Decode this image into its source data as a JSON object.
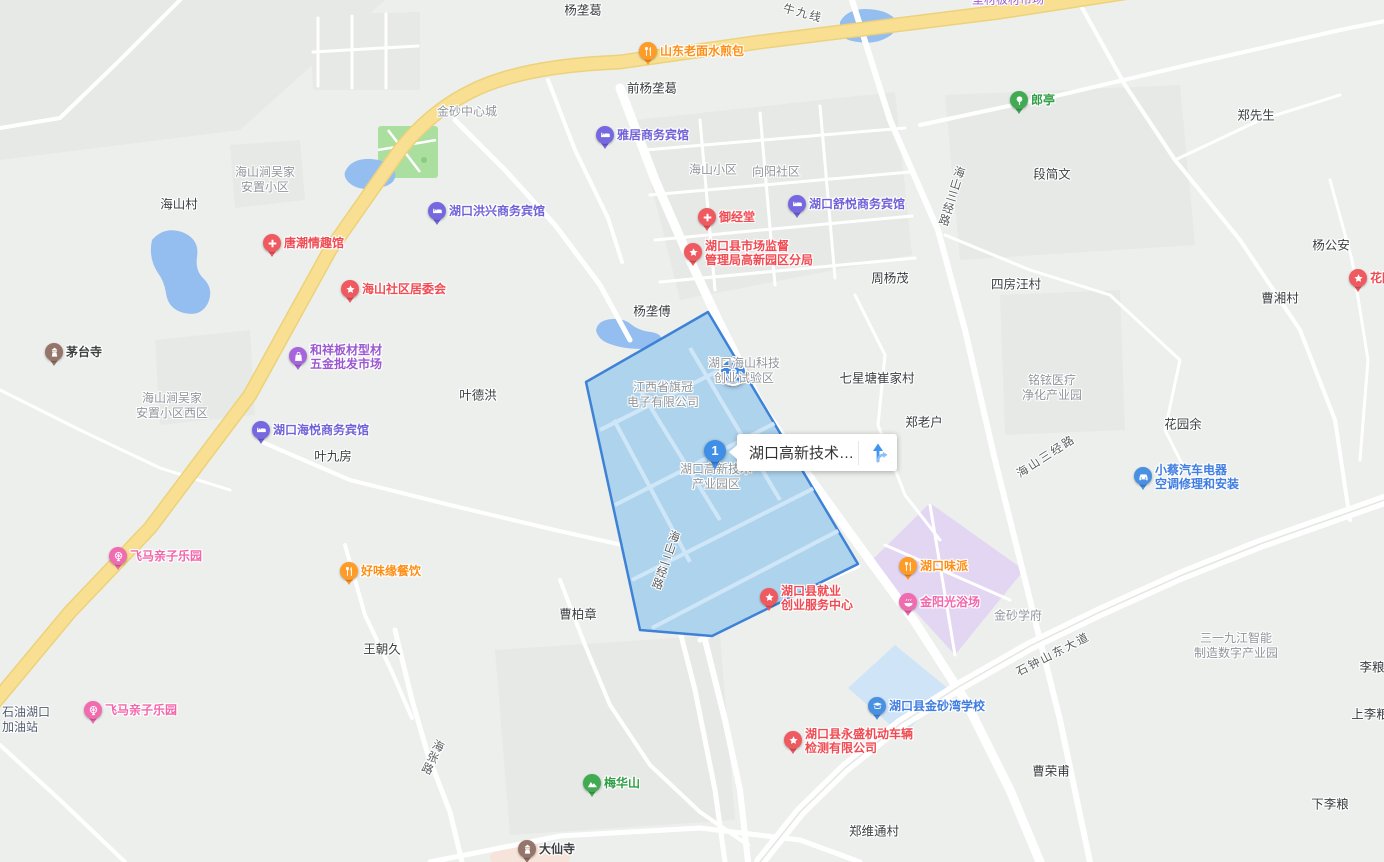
{
  "map": {
    "selection_popup": {
      "title": "湖口高新技术…",
      "marker_number": "1"
    },
    "palette": {
      "hotel": {
        "bg": "#7668e0",
        "text": "#6f62d9"
      },
      "food": {
        "bg": "#ff9b27",
        "text": "#ff8e15"
      },
      "red": {
        "bg": "#ef5a60",
        "text": "#f04a52"
      },
      "green": {
        "bg": "#41ab53",
        "text": "#2f9e44"
      },
      "pink": {
        "bg": "#f06bb0",
        "text": "#f266ab"
      },
      "blue": {
        "bg": "#4a90e2",
        "text": "#3f7de0"
      },
      "shop": {
        "bg": "#a765dd",
        "text": "#9b59d0"
      },
      "temple": {
        "bg": "#95756a",
        "text": "#3d4043"
      },
      "parking": {
        "bg": "#3f87e0",
        "text": "#3f87e0"
      },
      "selection": {
        "fill": "#aed3ed",
        "border": "#3e82d6"
      }
    },
    "poi": [
      {
        "icon": "food",
        "palette": "food",
        "x": 648,
        "y": 51,
        "lines": [
          "山东老面水煎包"
        ]
      },
      {
        "icon": "hotel",
        "palette": "hotel",
        "x": 605,
        "y": 135,
        "lines": [
          "雅居商务宾馆"
        ]
      },
      {
        "icon": "hotel",
        "palette": "hotel",
        "x": 437,
        "y": 211,
        "lines": [
          "湖口洪兴商务宾馆"
        ]
      },
      {
        "icon": "hotel",
        "palette": "hotel",
        "x": 797,
        "y": 204,
        "lines": [
          "湖口舒悦商务宾馆"
        ]
      },
      {
        "icon": "medical",
        "palette": "red",
        "x": 707,
        "y": 217,
        "lines": [
          "御经堂"
        ]
      },
      {
        "icon": "medical",
        "palette": "red",
        "x": 272,
        "y": 243,
        "lines": [
          "唐潮情趣馆"
        ]
      },
      {
        "icon": "star",
        "palette": "red",
        "x": 693,
        "y": 252,
        "lines": [
          "湖口县市场监督",
          "管理局高新园区分局"
        ]
      },
      {
        "icon": "tree",
        "palette": "green",
        "x": 1019,
        "y": 100,
        "lines": [
          "郎亭"
        ]
      },
      {
        "icon": "star",
        "palette": "red",
        "x": 350,
        "y": 289,
        "lines": [
          "海山社区居委会"
        ]
      },
      {
        "icon": "shop",
        "palette": "shop",
        "x": 298,
        "y": 356,
        "lines": [
          "和祥板材型材",
          "五金批发市场"
        ]
      },
      {
        "icon": "temple",
        "palette": "temple",
        "x": 54,
        "y": 352,
        "lines": [
          "茅台寺"
        ]
      },
      {
        "icon": "hotel",
        "palette": "hotel",
        "x": 261,
        "y": 430,
        "lines": [
          "湖口海悦商务宾馆"
        ]
      },
      {
        "icon": "parking",
        "palette": "parking",
        "x": 731,
        "y": 370,
        "big": true
      },
      {
        "icon": "fun",
        "palette": "pink",
        "x": 118,
        "y": 556,
        "lines": [
          "飞马亲子乐园"
        ]
      },
      {
        "icon": "food",
        "palette": "food",
        "x": 349,
        "y": 571,
        "lines": [
          "好味缘餐饮"
        ]
      },
      {
        "icon": "fun",
        "palette": "pink",
        "x": 93,
        "y": 710,
        "lines": [
          "飞马亲子乐园"
        ]
      },
      {
        "icon": "star",
        "palette": "red",
        "x": 769,
        "y": 597,
        "lines": [
          "湖口县就业",
          "创业服务中心"
        ]
      },
      {
        "icon": "food",
        "palette": "food",
        "x": 908,
        "y": 566,
        "lines": [
          "湖口味派"
        ]
      },
      {
        "icon": "bath",
        "palette": "pink",
        "x": 908,
        "y": 602,
        "lines": [
          "金阳光浴场"
        ]
      },
      {
        "icon": "car",
        "palette": "blue",
        "x": 1143,
        "y": 476,
        "lines": [
          "小蔡汽车电器",
          "空调修理和安装"
        ]
      },
      {
        "icon": "school",
        "palette": "blue",
        "x": 877,
        "y": 706,
        "lines": [
          "湖口县金砂湾学校"
        ]
      },
      {
        "icon": "star",
        "palette": "red",
        "x": 793,
        "y": 740,
        "lines": [
          "湖口县永盛机动车辆",
          "检测有限公司"
        ]
      },
      {
        "icon": "mountain",
        "palette": "green",
        "x": 592,
        "y": 783,
        "lines": [
          "梅华山"
        ]
      },
      {
        "icon": "temple",
        "palette": "temple",
        "x": 527,
        "y": 849,
        "lines": [
          "大仙寺"
        ]
      },
      {
        "icon": "star",
        "palette": "red",
        "x": 1358,
        "y": 278,
        "lines": [
          "花园"
        ]
      }
    ],
    "place_labels": [
      {
        "text": "杨垄葛",
        "x": 583,
        "y": 9
      },
      {
        "text": "前杨垄葛",
        "x": 652,
        "y": 87
      },
      {
        "text": "郑先生",
        "x": 1256,
        "y": 114
      },
      {
        "text": "段简文",
        "x": 1052,
        "y": 173
      },
      {
        "text": "海山村",
        "x": 179,
        "y": 203
      },
      {
        "text": "杨公安",
        "x": 1331,
        "y": 244
      },
      {
        "text": "周杨茂",
        "x": 890,
        "y": 277
      },
      {
        "text": "四房汪村",
        "x": 1016,
        "y": 283
      },
      {
        "text": "曹湘村",
        "x": 1280,
        "y": 297
      },
      {
        "text": "杨垄傅",
        "x": 652,
        "y": 310
      },
      {
        "text": "七星塘崔家村",
        "x": 877,
        "y": 377
      },
      {
        "text": "叶德洪",
        "x": 478,
        "y": 394
      },
      {
        "text": "郑老户",
        "x": 924,
        "y": 421
      },
      {
        "text": "花园余",
        "x": 1183,
        "y": 423
      },
      {
        "text": "叶九房",
        "x": 333,
        "y": 455
      },
      {
        "text": "曹柏章",
        "x": 578,
        "y": 613
      },
      {
        "text": "王朝久",
        "x": 382,
        "y": 648
      },
      {
        "text": "李粮",
        "x": 1372,
        "y": 666
      },
      {
        "text": "上李粮",
        "x": 1370,
        "y": 713
      },
      {
        "text": "曹荣甫",
        "x": 1051,
        "y": 770
      },
      {
        "text": "下李粮",
        "x": 1330,
        "y": 803
      },
      {
        "text": "郑维通村",
        "x": 874,
        "y": 830
      }
    ],
    "area_labels": [
      {
        "lines": [
          "金砂中心城"
        ],
        "x": 467,
        "y": 112
      },
      {
        "lines": [
          "海山小区"
        ],
        "x": 713,
        "y": 170
      },
      {
        "lines": [
          "向阳社区"
        ],
        "x": 776,
        "y": 172
      },
      {
        "lines": [
          "海山涧吴家",
          "安置小区"
        ],
        "x": 265,
        "y": 180
      },
      {
        "lines": [
          "海山涧吴家",
          "安置小区西区"
        ],
        "x": 172,
        "y": 406
      },
      {
        "lines": [
          "湖口海山科技",
          "创业试验区"
        ],
        "x": 744,
        "y": 371
      },
      {
        "lines": [
          "江西省旗冠",
          "电子有限公司"
        ],
        "x": 663,
        "y": 395
      },
      {
        "lines": [
          "湖口高新技术",
          "产业园区"
        ],
        "x": 716,
        "y": 477
      },
      {
        "lines": [
          "铭铉医疗",
          "净化产业园"
        ],
        "x": 1052,
        "y": 388
      },
      {
        "lines": [
          "金砂学府"
        ],
        "x": 1018,
        "y": 616
      },
      {
        "lines": [
          "三一九江智能",
          "制造数字产业园"
        ],
        "x": 1236,
        "y": 646
      },
      {
        "lines": [
          "石油湖口",
          "加油站"
        ],
        "x": 2,
        "y": 720,
        "align": "left",
        "color": "#4f5b6e"
      },
      {
        "lines": [
          "型材板材市场"
        ],
        "x": 1008,
        "y": 0,
        "color": "#9b59d0"
      }
    ],
    "road_labels": [
      {
        "text": "牛九线",
        "x": 803,
        "y": 13,
        "rotate": 15
      },
      {
        "text": "海山三经路",
        "x": 951,
        "y": 196,
        "vertical": true,
        "rotate": 17
      },
      {
        "text": "海山三经路",
        "x": 1046,
        "y": 456,
        "rotate": -33
      },
      {
        "text": "海山二经路",
        "x": 665,
        "y": 560,
        "vertical": true,
        "rotate": 19
      },
      {
        "text": "海张路",
        "x": 432,
        "y": 757,
        "vertical": true,
        "rotate": 25
      },
      {
        "text": "石钟山东大道",
        "x": 1053,
        "y": 654,
        "rotate": -27
      }
    ]
  }
}
